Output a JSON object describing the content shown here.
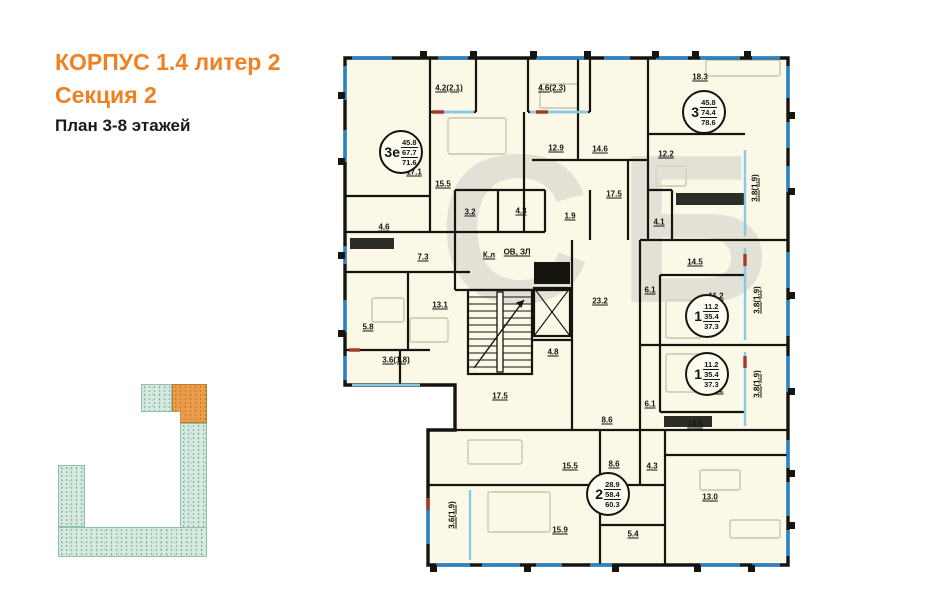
{
  "header": {
    "line1": "КОРПУС 1.4 литер 2",
    "line2": "Секция 2",
    "line3": "План 3-8 этажей"
  },
  "watermark": "СБ",
  "colors": {
    "accent_orange": "#F08121",
    "wall": "#15140e",
    "room_fill": "#FBF8E7",
    "window_blue": "#1F86D2",
    "balcony_blue": "#84CBEA",
    "red_accent": "#A53A2B",
    "minimap_teal": "#D5EBE0",
    "minimap_orange": "#EC9D4C",
    "watermark_gray": "#DAD9CF"
  },
  "apartment_stamps": [
    {
      "type": "3е",
      "area_living": "45.8",
      "area_main": "67.7",
      "area_total": "71.6",
      "x": 401,
      "y": 152
    },
    {
      "type": "3",
      "area_living": "45.8",
      "area_main": "74.4",
      "area_total": "78.6",
      "x": 704,
      "y": 112
    },
    {
      "type": "1",
      "area_living": "11.2",
      "area_main": "35.4",
      "area_total": "37.3",
      "x": 707,
      "y": 316
    },
    {
      "type": "1",
      "area_living": "11.2",
      "area_main": "35.4",
      "area_total": "37.3",
      "x": 707,
      "y": 374
    },
    {
      "type": "2",
      "area_living": "28.9",
      "area_main": "58.4",
      "area_total": "60.3",
      "x": 608,
      "y": 494
    }
  ],
  "room_labels": [
    {
      "t": "4.2(2.1)",
      "x": 449,
      "y": 88
    },
    {
      "t": "4.6(2.3)",
      "x": 552,
      "y": 88
    },
    {
      "t": "18.3",
      "x": 700,
      "y": 77
    },
    {
      "t": "17.1",
      "x": 414,
      "y": 172
    },
    {
      "t": "15.5",
      "x": 443,
      "y": 184
    },
    {
      "t": "12.9",
      "x": 556,
      "y": 148
    },
    {
      "t": "14.6",
      "x": 600,
      "y": 149
    },
    {
      "t": "12.2",
      "x": 666,
      "y": 154
    },
    {
      "t": "3.2",
      "x": 470,
      "y": 212
    },
    {
      "t": "4.3",
      "x": 521,
      "y": 211
    },
    {
      "t": "4.6",
      "x": 384,
      "y": 227
    },
    {
      "t": "1.9",
      "x": 570,
      "y": 216
    },
    {
      "t": "17.5",
      "x": 614,
      "y": 194
    },
    {
      "t": "4.1",
      "x": 659,
      "y": 222
    },
    {
      "t": "3.8(1.9)",
      "x": 755,
      "y": 188,
      "rot": true
    },
    {
      "t": "7.3",
      "x": 423,
      "y": 257
    },
    {
      "t": "К.л",
      "x": 489,
      "y": 255
    },
    {
      "t": "ОВ, ЗЛ",
      "x": 517,
      "y": 252
    },
    {
      "t": "23.2",
      "x": 600,
      "y": 301
    },
    {
      "t": "5.8",
      "x": 368,
      "y": 327
    },
    {
      "t": "13.1",
      "x": 440,
      "y": 305
    },
    {
      "t": "3.6(1.8)",
      "x": 396,
      "y": 360
    },
    {
      "t": "4.8",
      "x": 553,
      "y": 352
    },
    {
      "t": "14.5",
      "x": 695,
      "y": 262
    },
    {
      "t": "6.1",
      "x": 650,
      "y": 290
    },
    {
      "t": "11.2",
      "x": 716,
      "y": 296
    },
    {
      "t": "3.8(1.9)",
      "x": 757,
      "y": 300,
      "rot": true
    },
    {
      "t": "11.2",
      "x": 716,
      "y": 390
    },
    {
      "t": "3.8(1.9)",
      "x": 757,
      "y": 384,
      "rot": true
    },
    {
      "t": "6.1",
      "x": 650,
      "y": 404
    },
    {
      "t": "14.5",
      "x": 695,
      "y": 424
    },
    {
      "t": "17.5",
      "x": 500,
      "y": 396
    },
    {
      "t": "8.6",
      "x": 607,
      "y": 420
    },
    {
      "t": "15.5",
      "x": 570,
      "y": 466
    },
    {
      "t": "8.6",
      "x": 614,
      "y": 464
    },
    {
      "t": "4.3",
      "x": 652,
      "y": 466
    },
    {
      "t": "13.0",
      "x": 710,
      "y": 497
    },
    {
      "t": "5.4",
      "x": 633,
      "y": 534
    },
    {
      "t": "15.9",
      "x": 560,
      "y": 530
    },
    {
      "t": "3.6(1.9)",
      "x": 452,
      "y": 515,
      "rot": true
    }
  ]
}
